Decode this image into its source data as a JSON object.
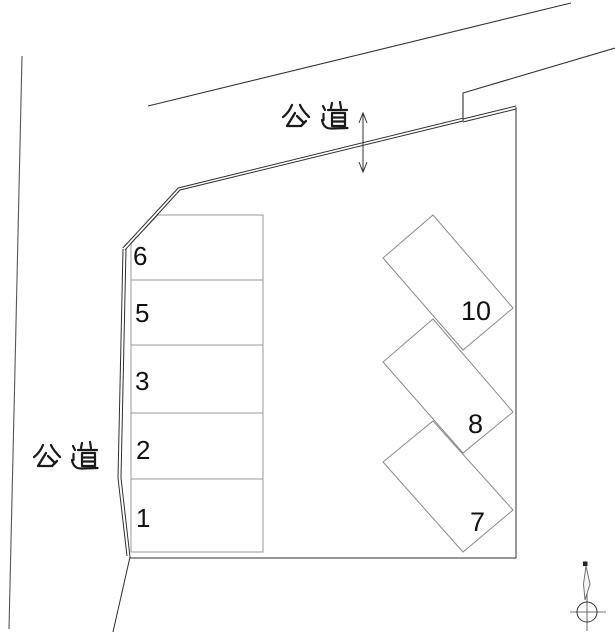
{
  "plan": {
    "background": "#ffffff",
    "line_color": "#2f2f2f",
    "stall_outline_color": "#999999",
    "text_color": "#111111"
  },
  "roads": {
    "top": {
      "label": "公 道"
    },
    "left": {
      "label": "公 道"
    }
  },
  "stalls": {
    "left": [
      "6",
      "5",
      "3",
      "2",
      "1"
    ],
    "right": [
      "10",
      "8",
      "7"
    ]
  }
}
